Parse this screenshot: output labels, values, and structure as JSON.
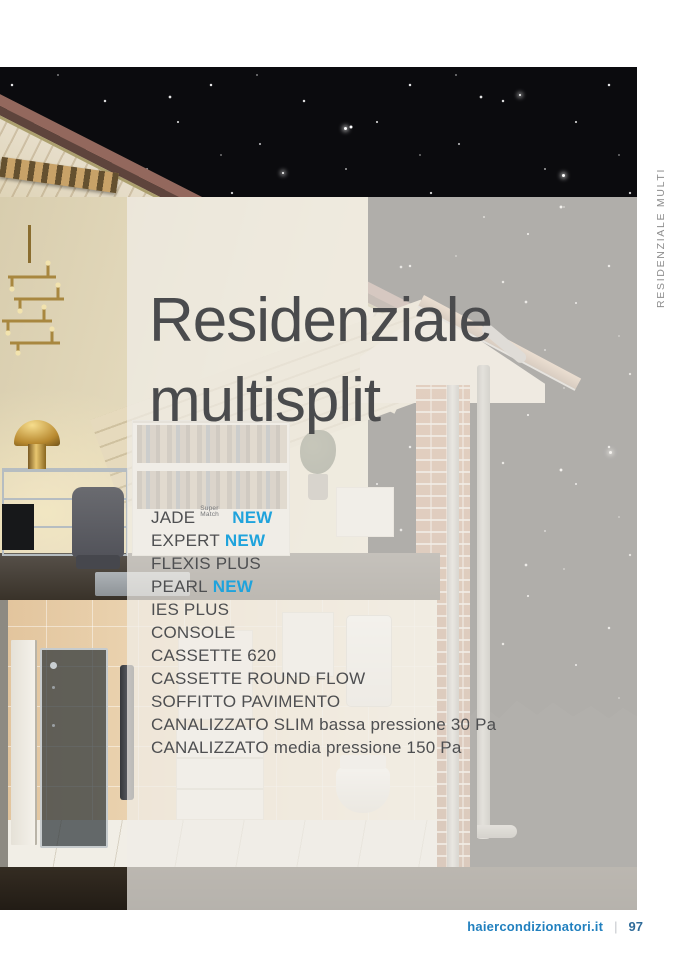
{
  "hero": {
    "title_line1": "Residenziale",
    "title_line2": "multisplit"
  },
  "products": [
    {
      "name": "JADE",
      "superscript": "Super Match",
      "badge": "NEW",
      "detail": ""
    },
    {
      "name": "EXPERT",
      "superscript": "",
      "badge": "NEW",
      "detail": ""
    },
    {
      "name": "FLEXIS PLUS",
      "superscript": "",
      "badge": "",
      "detail": ""
    },
    {
      "name": "PEARL",
      "superscript": "",
      "badge": "NEW",
      "detail": ""
    },
    {
      "name": "IES PLUS",
      "superscript": "",
      "badge": "",
      "detail": ""
    },
    {
      "name": "CONSOLE",
      "superscript": "",
      "badge": "",
      "detail": ""
    },
    {
      "name": "CASSETTE 620",
      "superscript": "",
      "badge": "",
      "detail": ""
    },
    {
      "name": "CASSETTE ROUND FLOW",
      "superscript": "",
      "badge": "",
      "detail": ""
    },
    {
      "name": "SOFFITTO PAVIMENTO",
      "superscript": "",
      "badge": "",
      "detail": ""
    },
    {
      "name": "CANALIZZATO SLIM",
      "superscript": "",
      "badge": "",
      "detail": "bassa pressione 30 Pa"
    },
    {
      "name": "CANALIZZATO",
      "superscript": "",
      "badge": "",
      "detail": "media pressione 150 Pa"
    }
  ],
  "side_label": "RESIDENZIALE MULTI",
  "footer": {
    "site": "haiercondizionatori.it",
    "separator": "|",
    "page_number": "97"
  },
  "colors": {
    "accent_new": "#1FA3DC",
    "title_text": "#4A4B4D",
    "list_text": "#4E4F51",
    "footer_link": "#2180BF",
    "footer_page_number": "#2F6B99",
    "side_label_text": "#8D8D8D",
    "overlay_panel": "rgba(240,237,232,0.72)",
    "night_sky": "#0B0B0E"
  }
}
